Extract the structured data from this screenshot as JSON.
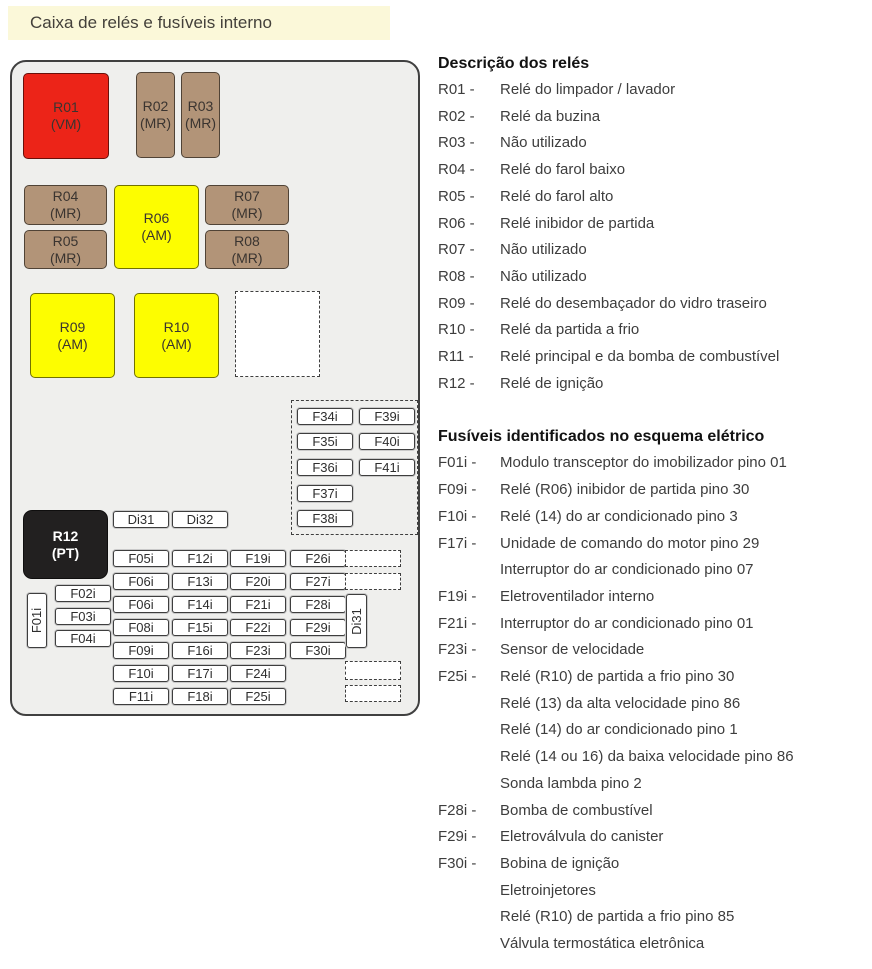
{
  "page": {
    "title": "Caixa de relés e fusíveis interno"
  },
  "colors": {
    "title_bg": "#fbf8d9",
    "diagram_bg": "#efefed",
    "relay_red": "#ec2418",
    "relay_tan": "#b29478",
    "relay_yellow": "#fdfd00",
    "relay_black": "#222020"
  },
  "diagram": {
    "relays": [
      {
        "id": "R01",
        "code": "(VM)"
      },
      {
        "id": "R02",
        "code": "(MR)"
      },
      {
        "id": "R03",
        "code": "(MR)"
      },
      {
        "id": "R04",
        "code": "(MR)"
      },
      {
        "id": "R05",
        "code": "(MR)"
      },
      {
        "id": "R06",
        "code": "(AM)"
      },
      {
        "id": "R07",
        "code": "(MR)"
      },
      {
        "id": "R08",
        "code": "(MR)"
      },
      {
        "id": "R09",
        "code": "(AM)"
      },
      {
        "id": "R10",
        "code": "(AM)"
      },
      {
        "id": "R12",
        "code": "(PT)"
      }
    ],
    "diodes": {
      "di31": "Di31",
      "di32": "Di32",
      "di31_vertical": "Di31"
    },
    "vertical_fuse": "F01i",
    "left_fuses": [
      "F02i",
      "F03i",
      "F04i"
    ],
    "top_group": {
      "col1": [
        "F34i",
        "F35i",
        "F36i",
        "F37i",
        "F38i"
      ],
      "col2": [
        "F39i",
        "F40i",
        "F41i"
      ]
    },
    "grid_col1": [
      "F05i",
      "F06i",
      "F06i",
      "F08i",
      "F09i",
      "F10i",
      "F11i"
    ],
    "grid_col2": [
      "F12i",
      "F13i",
      "F14i",
      "F15i",
      "F16i",
      "F17i",
      "F18i"
    ],
    "grid_col3": [
      "F19i",
      "F20i",
      "F21i",
      "F22i",
      "F23i",
      "F24i",
      "F25i"
    ],
    "grid_col4": [
      "F26i",
      "F27i",
      "F28i",
      "F29i",
      "F30i"
    ]
  },
  "relay_section": {
    "heading": "Descrição dos relés",
    "items": [
      {
        "label": "R01 -",
        "desc": "Relé do limpador / lavador"
      },
      {
        "label": "R02 -",
        "desc": "Relé da buzina"
      },
      {
        "label": "R03 -",
        "desc": "Não utilizado"
      },
      {
        "label": "R04 -",
        "desc": "Relé do farol baixo"
      },
      {
        "label": "R05 -",
        "desc": "Relé do farol alto"
      },
      {
        "label": "R06 -",
        "desc": "Relé inibidor de partida"
      },
      {
        "label": "R07 -",
        "desc": "Não utilizado"
      },
      {
        "label": "R08 -",
        "desc": "Não utilizado"
      },
      {
        "label": "R09 -",
        "desc": "Relé do desembaçador do vidro traseiro"
      },
      {
        "label": "R10 -",
        "desc": "Relé da partida a frio"
      },
      {
        "label": "R11 -",
        "desc": "Relé principal e da bomba de combustível"
      },
      {
        "label": "R12 -",
        "desc": "Relé de ignição"
      }
    ]
  },
  "fuse_section": {
    "heading": "Fusíveis identificados no esquema elétrico",
    "items": [
      {
        "label": "F01i -",
        "lines": [
          "Modulo transceptor do imobilizador pino 01"
        ]
      },
      {
        "label": "F09i -",
        "lines": [
          "Relé (R06) inibidor de partida pino 30"
        ]
      },
      {
        "label": "F10i -",
        "lines": [
          "Relé (14) do ar condicionado pino 3"
        ]
      },
      {
        "label": "F17i -",
        "lines": [
          "Unidade de comando do motor pino 29",
          "Interruptor do ar condicionado pino 07"
        ]
      },
      {
        "label": "F19i -",
        "lines": [
          "Eletroventilador interno"
        ]
      },
      {
        "label": "F21i -",
        "lines": [
          "Interruptor do ar condicionado pino 01"
        ]
      },
      {
        "label": "F23i -",
        "lines": [
          "Sensor de velocidade"
        ]
      },
      {
        "label": "F25i -",
        "lines": [
          "Relé (R10) de partida a frio pino 30",
          "Relé (13) da alta velocidade pino 86",
          "Relé (14) do ar condicionado pino 1",
          "Relé (14 ou 16) da baixa velocidade pino 86",
          "Sonda lambda pino 2"
        ]
      },
      {
        "label": "F28i -",
        "lines": [
          "Bomba de combustível"
        ]
      },
      {
        "label": "F29i -",
        "lines": [
          "Eletroválvula do canister"
        ]
      },
      {
        "label": "F30i -",
        "lines": [
          "Bobina de ignição",
          "Eletroinjetores",
          "Relé (R10) de partida a frio pino 85",
          "Válvula termostática eletrônica"
        ]
      }
    ]
  }
}
